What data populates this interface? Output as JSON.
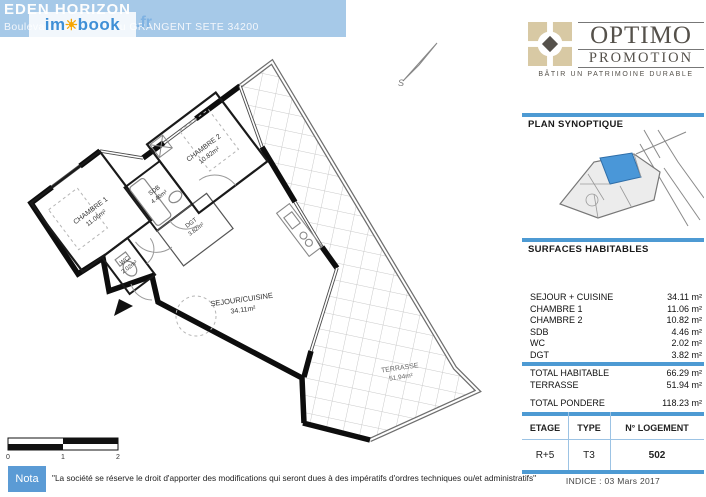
{
  "header": {
    "title": "EDEN HORIZON",
    "address": "Boulevard Jean Mathieu GRANGENT SETE 34200",
    "watermark": {
      "part1": "im",
      "sun": "☀",
      "part2": "book",
      "suffix": ".fr"
    }
  },
  "logo": {
    "name_line1": "OPTIMO",
    "name_line2": "PROMOTION",
    "tagline": "BÂTIR UN PATRIMOINE DURABLE"
  },
  "panel": {
    "plan_synoptique_title": "PLAN SYNOPTIQUE",
    "surfaces_title": "SURFACES HABITABLES",
    "rooms": [
      {
        "label": "SEJOUR + CUISINE",
        "value": "34.11 m²"
      },
      {
        "label": "CHAMBRE 1",
        "value": "11.06 m²"
      },
      {
        "label": "CHAMBRE 2",
        "value": "10.82 m²"
      },
      {
        "label": "SDB",
        "value": "4.46 m²"
      },
      {
        "label": "WC",
        "value": "2.02 m²"
      },
      {
        "label": "DGT",
        "value": "3.82 m²"
      }
    ],
    "totals": [
      {
        "label": "TOTAL HABITABLE",
        "value": "66.29 m²"
      },
      {
        "label": "TERRASSE",
        "value": "51.94 m²"
      }
    ],
    "pondere": {
      "label": "TOTAL PONDERE",
      "value": "118.23 m²"
    },
    "logement": {
      "headers": [
        "ETAGE",
        "TYPE",
        "N° LOGEMENT"
      ],
      "values": [
        "R+5",
        "T3",
        "502"
      ]
    },
    "indice": "INDICE : 03 Mars 2017"
  },
  "plan": {
    "rooms": [
      {
        "name": "CHAMBRE 1",
        "area": "11.06m²"
      },
      {
        "name": "CHAMBRE 2",
        "area": "10.82m²"
      },
      {
        "name": "SDB",
        "area": "4.46m²"
      },
      {
        "name": "WC",
        "area": "2.02m²"
      },
      {
        "name": "DGT",
        "area": "3.82m²"
      },
      {
        "name": "SEJOUR/CUISINE",
        "area": "34.11m²"
      },
      {
        "name": "TERRASSE",
        "area": "51.94m²"
      }
    ],
    "compass_letter": "S",
    "scale": {
      "labels": [
        "0",
        "1",
        "2"
      ]
    }
  },
  "nota": {
    "label": "Nota",
    "text": "\"La société se réserve le droit d'apporter des modifications qui seront dues à des impératifs d'ordres techniques ou/et administratifs\""
  },
  "colors": {
    "accent_blue": "#4d9ad3",
    "banner_blue": "#a6c9e8",
    "sun_orange": "#f7a600",
    "logo_beige": "#d8c9a4",
    "synoptique_highlight": "#4a97d8"
  }
}
